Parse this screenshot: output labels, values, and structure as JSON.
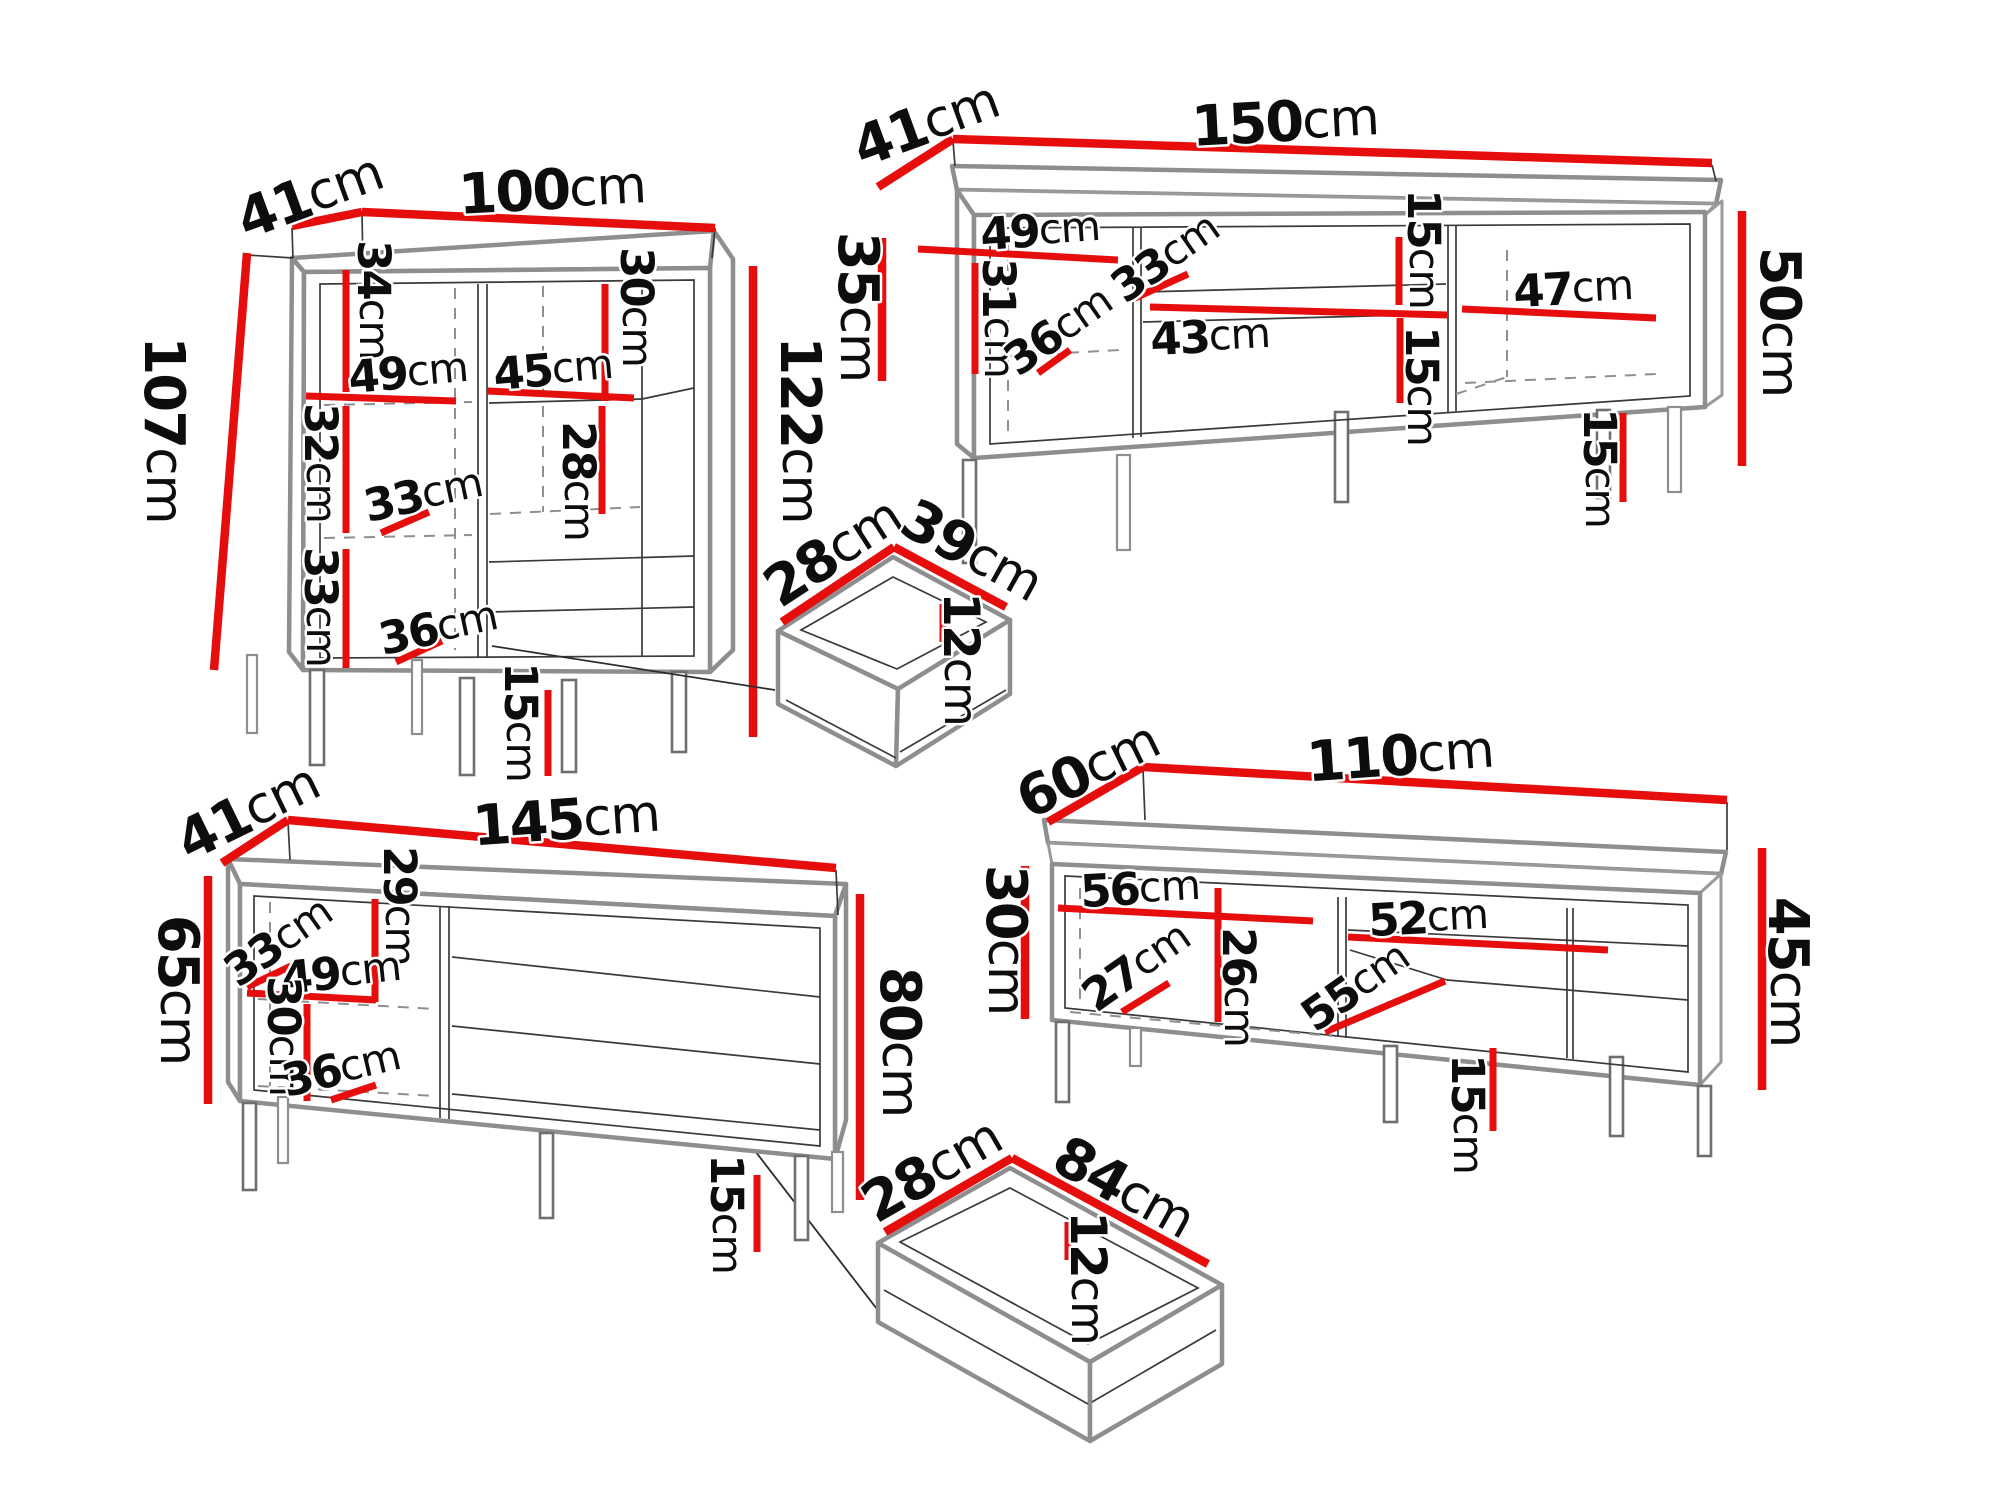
{
  "meta": {
    "diagram_type": "furniture-dimension-drawing",
    "unit": "cm",
    "accent_color": "#e60d0d",
    "line_color": "#8e8e8e",
    "text_color": "#0d0d0d",
    "background": "#ffffff"
  },
  "pieces": [
    {
      "id": "highboard-100",
      "labels": [
        "41",
        "100",
        "107",
        "122",
        "34",
        "30",
        "49",
        "45",
        "32",
        "33",
        "28",
        "33",
        "36",
        "15"
      ]
    },
    {
      "id": "tv-stand-150",
      "labels": [
        "41",
        "150",
        "35",
        "50",
        "49",
        "31",
        "36",
        "33",
        "15",
        "43",
        "15",
        "47",
        "15"
      ]
    },
    {
      "id": "drawer-39",
      "labels": [
        "28",
        "39",
        "12"
      ]
    },
    {
      "id": "sideboard-145",
      "labels": [
        "41",
        "145",
        "65",
        "80",
        "29",
        "33",
        "49",
        "30",
        "36",
        "15"
      ]
    },
    {
      "id": "tv-stand-110",
      "labels": [
        "60",
        "110",
        "30",
        "45",
        "56",
        "27",
        "26",
        "52",
        "55",
        "15"
      ]
    },
    {
      "id": "drawer-84",
      "labels": [
        "28",
        "84",
        "12"
      ]
    }
  ]
}
